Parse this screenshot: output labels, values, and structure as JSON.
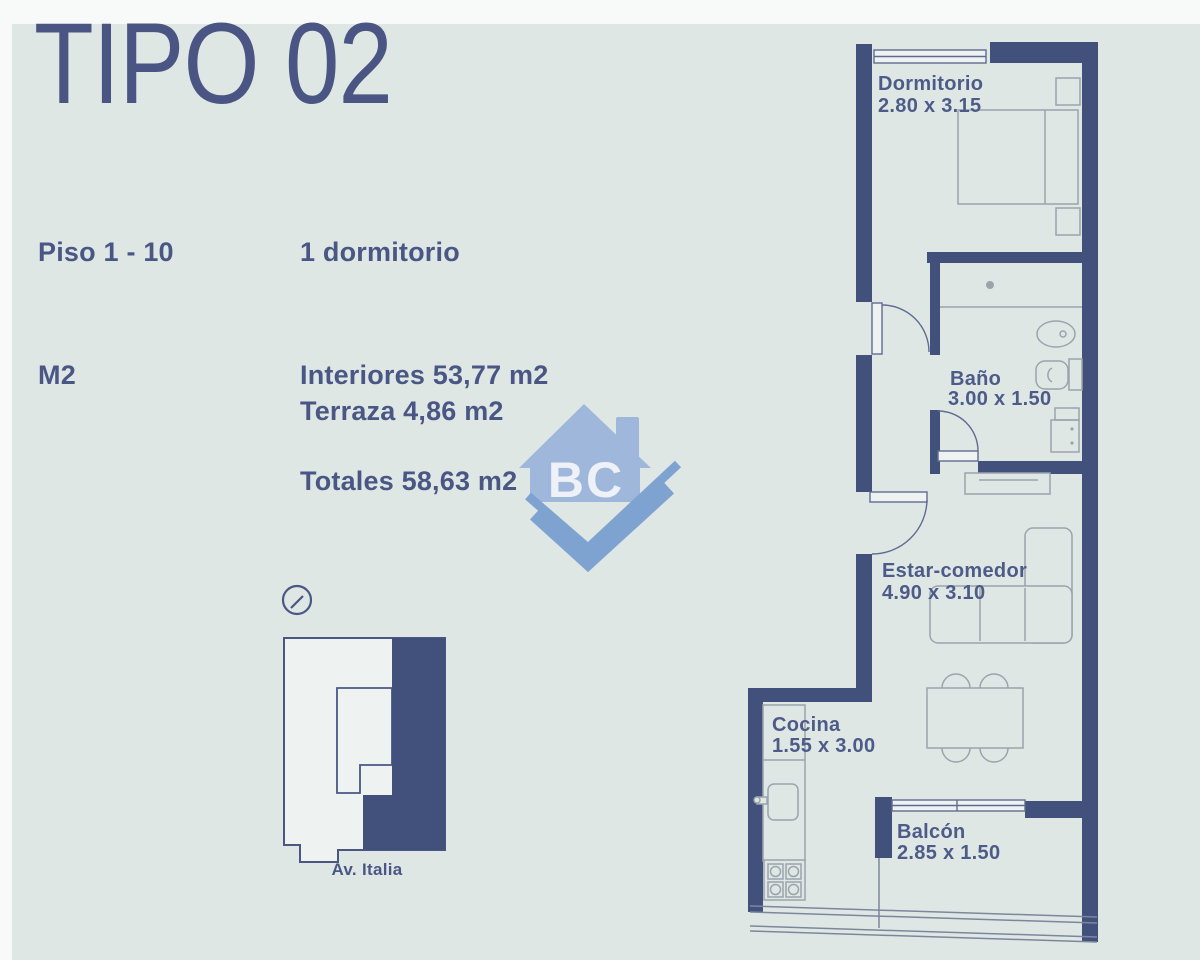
{
  "header": {
    "title": "TIPO 02"
  },
  "specs": {
    "floor_label": "Piso 1 - 10",
    "bedroom_label": "1 dormitorio",
    "m2_label": "M2",
    "interiores": "Interiores 53,77 m2",
    "terraza": "Terraza 4,86 m2",
    "totales": "Totales 58,63 m2"
  },
  "logo": {
    "text": "BC"
  },
  "keyplan": {
    "street": "Av. Italia"
  },
  "rooms": {
    "dormitorio": {
      "name": "Dormitorio",
      "dims": "2.80 x 3.15"
    },
    "bano": {
      "name": "Baño",
      "dims": "3.00 x 1.50"
    },
    "estar": {
      "name": "Estar-comedor",
      "dims": "4.90 x 3.10"
    },
    "cocina": {
      "name": "Cocina",
      "dims": "1.55 x 3.00"
    },
    "balcon": {
      "name": "Balcón",
      "dims": "2.85 x 1.50"
    }
  },
  "colors": {
    "background_panel": "#dfe7e5",
    "page_border": "#f8fafa",
    "wall": "#42517c",
    "text": "#4a5785",
    "furniture_line": "#9aa4ac",
    "fixture_line": "#5f6c90",
    "logo_house": "#9fb7da",
    "logo_check": "#7fa3d1",
    "keyplan_fill": "#42517c"
  }
}
